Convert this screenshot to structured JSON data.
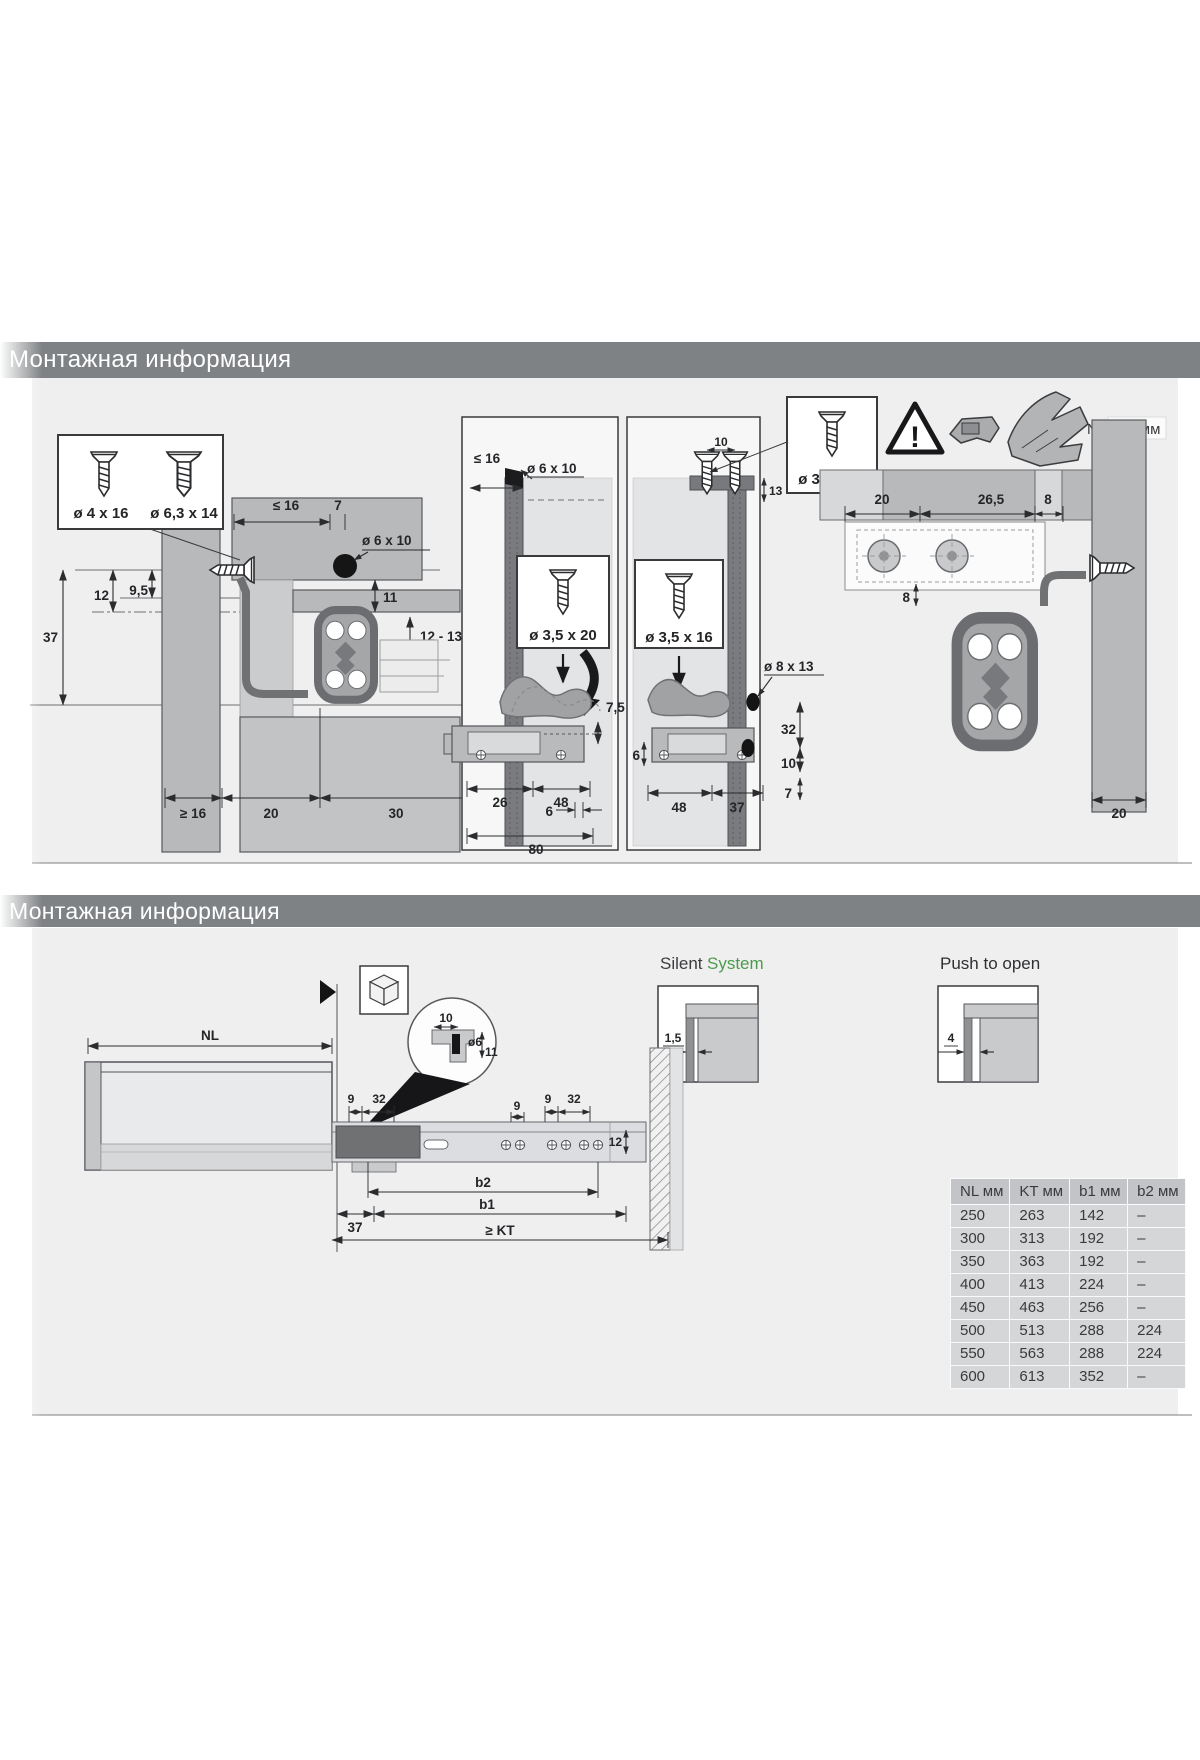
{
  "accent_green": "#4c9b4c",
  "header_bar_color": "#7f8285",
  "s1": {
    "header": "Монтажная информация",
    "legend": {
      "screw_small": "ø 4 x 16",
      "screw_large": "ø 6,3 x 14"
    },
    "left": {
      "panel_max": "≤ 16",
      "d7": "7",
      "hole": "ø 6 x 10",
      "d12": "12",
      "d95": "9,5",
      "d37": "37",
      "d11": "11",
      "d1213": "12 - 13",
      "ge16": "≥ 16",
      "d20": "20",
      "d30": "30"
    },
    "panel_a": {
      "wall_max": "≤ 16",
      "hole": "ø 6 x 10",
      "screw": "ø 3,5 x 20",
      "d75": "7,5",
      "d26": "26",
      "d48": "48",
      "d6": "6",
      "d80": "80"
    },
    "panel_b": {
      "screw": "ø 3,5 x 16",
      "d10": "10",
      "d13": "13",
      "d6": "6",
      "hole": "ø 8 x 13",
      "d32": "32",
      "d10b": "10",
      "d7": "7",
      "d48": "48",
      "d37": "37"
    },
    "icons": {
      "screw": "ø 3,5 x 20",
      "warn": "!",
      "nl_note": "NL - 12 мм"
    },
    "right": {
      "d20": "20",
      "d265": "26,5",
      "d8": "8",
      "d8b": "8",
      "d20b": "20"
    }
  },
  "s2": {
    "header": "Монтажная информация",
    "silent": {
      "word1": "Silent",
      "word2": "System",
      "dim": "1,5"
    },
    "push": {
      "label": "Push to open",
      "dim": "4"
    },
    "drawing": {
      "nl": "NL",
      "d10": "10",
      "dia6": "ø6",
      "d11": "11",
      "d9a": "9",
      "d32a": "32",
      "d9b": "9",
      "d9c": "9",
      "d32b": "32",
      "d12": "12",
      "b2": "b2",
      "b1": "b1",
      "d37": "37",
      "kt": "≥ KT"
    },
    "table": {
      "headers": [
        "NL мм",
        "KT мм",
        "b1 мм",
        "b2 мм"
      ],
      "rows": [
        [
          "250",
          "263",
          "142",
          "–"
        ],
        [
          "300",
          "313",
          "192",
          "–"
        ],
        [
          "350",
          "363",
          "192",
          "–"
        ],
        [
          "400",
          "413",
          "224",
          "–"
        ],
        [
          "450",
          "463",
          "256",
          "–"
        ],
        [
          "500",
          "513",
          "288",
          "224"
        ],
        [
          "550",
          "563",
          "288",
          "224"
        ],
        [
          "600",
          "613",
          "352",
          "–"
        ]
      ]
    }
  }
}
